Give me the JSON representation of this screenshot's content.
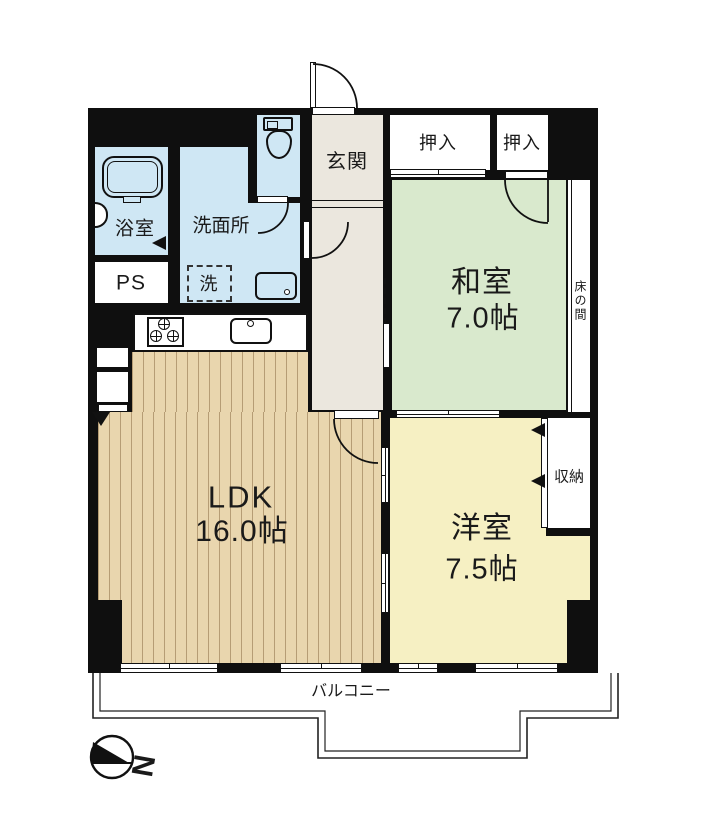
{
  "rooms": {
    "genkan": {
      "label": "玄関"
    },
    "oshiire_a": {
      "label": "押入"
    },
    "oshiire_b": {
      "label": "押入"
    },
    "washitsu": {
      "label": "和室",
      "size": "7.0帖"
    },
    "tokonoma": {
      "label": "床の間"
    },
    "shuno": {
      "label": "収納"
    },
    "yoshitsu": {
      "label": "洋室",
      "size": "7.5帖"
    },
    "ldk": {
      "label": "LDK",
      "size": "16.0帖"
    },
    "bath": {
      "label": "浴室"
    },
    "senmenjo": {
      "label": "洗面所"
    },
    "laundry": {
      "label": "洗"
    },
    "ps": {
      "label": "PS"
    },
    "balcony": {
      "label": "バルコニー"
    }
  },
  "compass": {
    "label": "N"
  },
  "colors": {
    "wall": "#0f0f0f",
    "wet_rooms": "#cfe7f4",
    "tatami_room": "#d9e9cd",
    "western_room": "#f6f0c3",
    "ldk_floor": "#e9d6ae",
    "entry_hall": "#ebe7de"
  },
  "fixtures": [
    "bathtub",
    "toilet",
    "washbasin",
    "kitchen-sink",
    "gas-stove",
    "washing-machine"
  ]
}
